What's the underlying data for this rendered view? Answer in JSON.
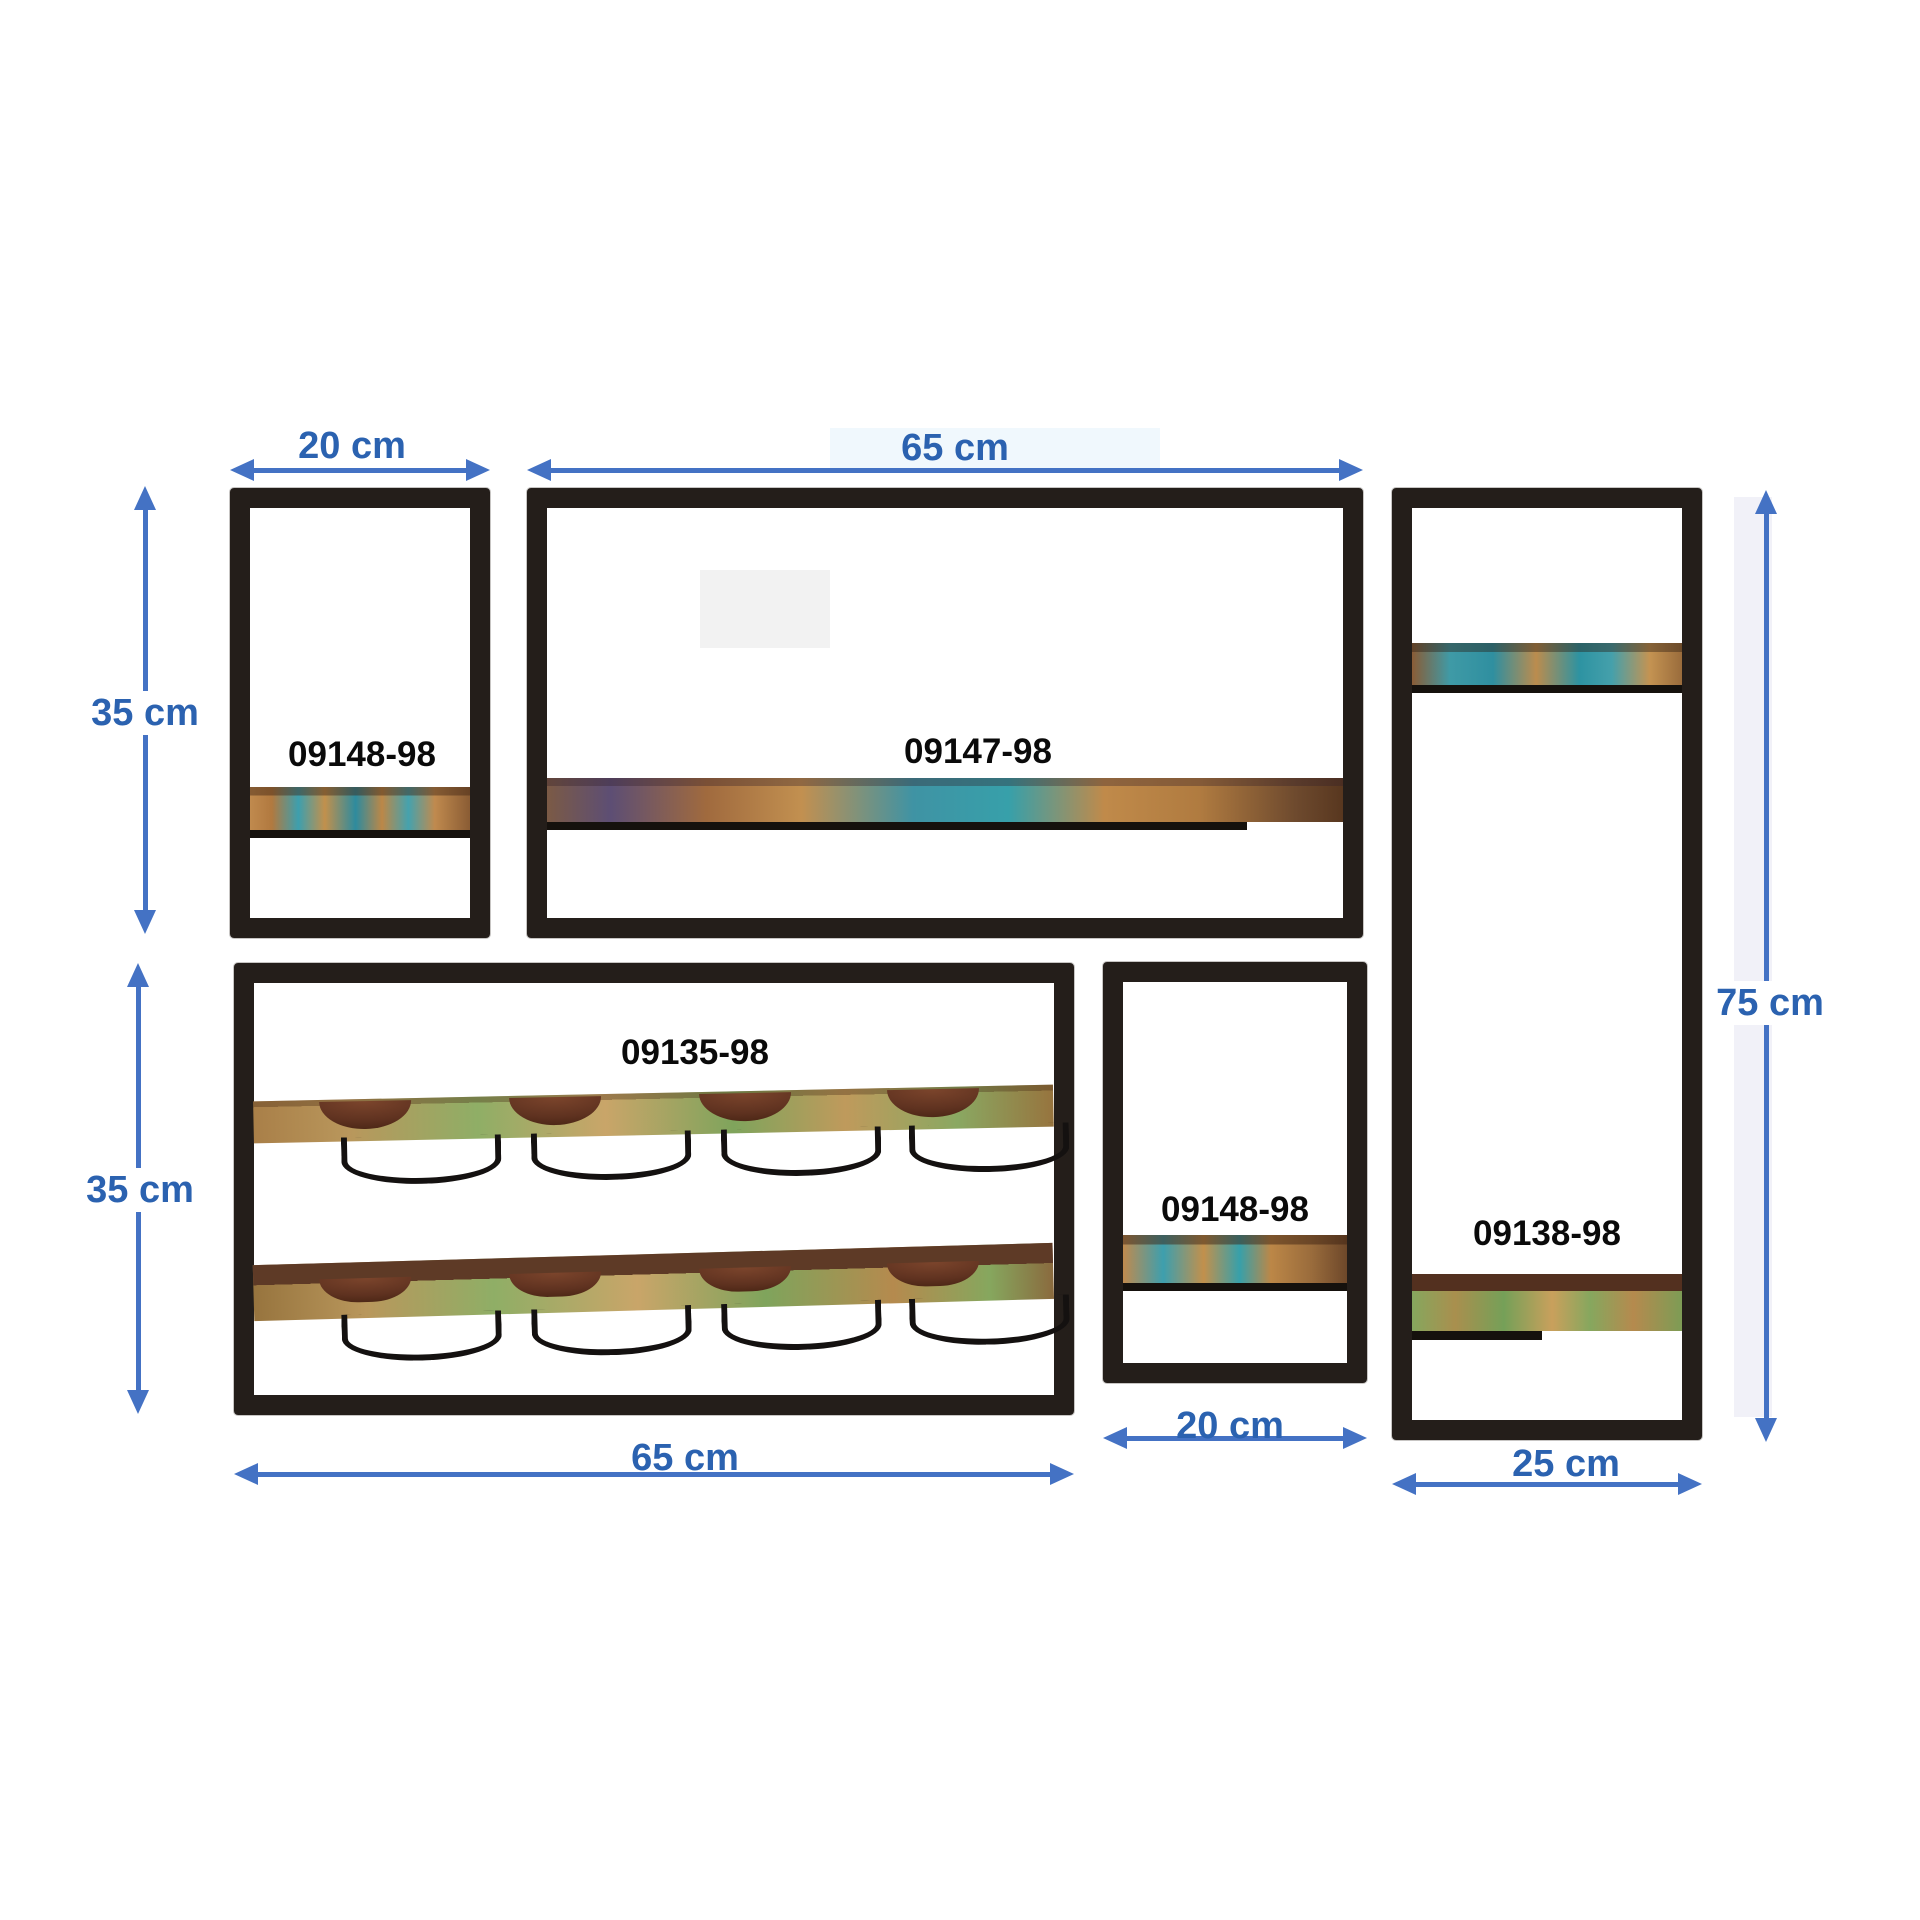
{
  "diagram": {
    "background_color": "#ffffff",
    "arrow_color": "#4472C4",
    "dimension_text_color": "#2B62B0",
    "frame_color": "#241e1a",
    "product_code_text_color": "#0a0a0a",
    "units": [
      {
        "id": "top-left-shelf",
        "code": "09148-98"
      },
      {
        "id": "top-middle-shelf",
        "code": "09147-98"
      },
      {
        "id": "right-tall-shelf",
        "code": "09138-98"
      },
      {
        "id": "wine-rack",
        "code": "09135-98"
      },
      {
        "id": "bottom-middle-shelf",
        "code": "09148-98"
      }
    ],
    "dimensions": [
      {
        "id": "top-left-width",
        "text": "20 cm",
        "orientation": "horizontal"
      },
      {
        "id": "top-middle-width",
        "text": "65 cm",
        "orientation": "horizontal"
      },
      {
        "id": "top-left-height",
        "text": "35 cm",
        "orientation": "vertical"
      },
      {
        "id": "wine-rack-height",
        "text": "35 cm",
        "orientation": "vertical"
      },
      {
        "id": "wine-rack-width",
        "text": "65 cm",
        "orientation": "horizontal"
      },
      {
        "id": "bottom-middle-width",
        "text": "20 cm",
        "orientation": "horizontal"
      },
      {
        "id": "right-shelf-width",
        "text": "25 cm",
        "orientation": "horizontal"
      },
      {
        "id": "right-shelf-height",
        "text": "75 cm",
        "orientation": "vertical"
      }
    ]
  }
}
